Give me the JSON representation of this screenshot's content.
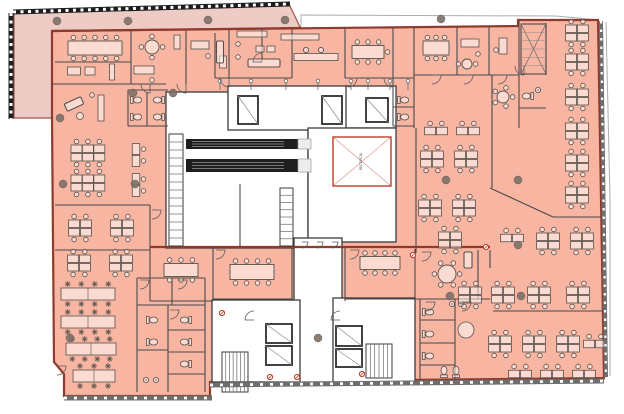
{
  "meta": {
    "document_type": "architectural office floor plan"
  },
  "colors": {
    "terrace": "#eecbc5",
    "office": "#f7b5a2",
    "office_border": "#8f3b2d",
    "wall": "#4a4a4a",
    "core_wall": "#3c3c3c",
    "white": "#ffffff",
    "furniture": "#57524c",
    "furniture_fill": "rgba(255,255,255,0.5)",
    "column": "#7d7168",
    "accent_red": "#c23b2a",
    "escalator": "#1e1e1e",
    "facade_dark": "#1d1d1d",
    "facade_gray": "#6e6e6e",
    "outline_gray": "#adadad"
  },
  "void_room": {
    "x": 333,
    "y": 137,
    "w": 58,
    "h": 49,
    "label": "RECEPCJA"
  },
  "plan": {
    "terrace_points": "14,12 289,4 301,29 52,31 52,118 14,118",
    "office_points": "52,31 518,26 518,20 598,20 604,378 210,382 210,396 64,396 64,374 54,362 52,118",
    "roof_outline": "301,29 301,15 556,16 598,20",
    "right_offset": "606,22 610,200 610,376",
    "cores": [
      [
        166,
        92,
        142,
        156
      ],
      [
        228,
        86,
        120,
        44
      ],
      [
        346,
        86,
        50,
        42
      ],
      [
        308,
        128,
        88,
        114
      ],
      [
        294,
        238,
        48,
        144
      ],
      [
        212,
        300,
        88,
        82
      ],
      [
        333,
        298,
        82,
        84
      ]
    ],
    "walls": [
      [
        131,
        31,
        131,
        84
      ],
      [
        186,
        30,
        186,
        84
      ],
      [
        215,
        33,
        215,
        78
      ],
      [
        229,
        30,
        229,
        78
      ],
      [
        262,
        29,
        262,
        62
      ],
      [
        292,
        29,
        292,
        78
      ],
      [
        345,
        28,
        345,
        78
      ],
      [
        393,
        28,
        393,
        88
      ],
      [
        414,
        27,
        414,
        128
      ],
      [
        457,
        27,
        457,
        75
      ],
      [
        489,
        27,
        489,
        75
      ],
      [
        519,
        20,
        519,
        75
      ],
      [
        546,
        23,
        546,
        75
      ],
      [
        519,
        75,
        519,
        128
      ],
      [
        519,
        108,
        546,
        108
      ],
      [
        55,
        62,
        131,
        62
      ],
      [
        52,
        84,
        166,
        84
      ],
      [
        215,
        78,
        292,
        78
      ],
      [
        345,
        78,
        414,
        78
      ],
      [
        414,
        75,
        519,
        75
      ],
      [
        128,
        90,
        168,
        90
      ],
      [
        128,
        90,
        128,
        126
      ],
      [
        128,
        126,
        168,
        126
      ],
      [
        147,
        92,
        147,
        126
      ],
      [
        393,
        88,
        393,
        126
      ],
      [
        393,
        126,
        414,
        126
      ],
      [
        393,
        107,
        414,
        107
      ],
      [
        55,
        205,
        150,
        205
      ],
      [
        150,
        205,
        150,
        250
      ],
      [
        55,
        250,
        150,
        250
      ],
      [
        137,
        278,
        205,
        278
      ],
      [
        172,
        278,
        172,
        305
      ],
      [
        137,
        305,
        205,
        305
      ],
      [
        137,
        278,
        137,
        392
      ],
      [
        205,
        278,
        205,
        392
      ],
      [
        168,
        305,
        168,
        392
      ],
      [
        168,
        330,
        205,
        330
      ],
      [
        168,
        352,
        205,
        352
      ],
      [
        137,
        350,
        168,
        350
      ],
      [
        168,
        374,
        205,
        374
      ],
      [
        150,
        249,
        150,
        301
      ],
      [
        213,
        246,
        213,
        301
      ],
      [
        292,
        246,
        292,
        301
      ],
      [
        345,
        246,
        345,
        301
      ],
      [
        415,
        249,
        415,
        301
      ],
      [
        150,
        301,
        213,
        301
      ],
      [
        213,
        299,
        292,
        299
      ],
      [
        345,
        299,
        420,
        299
      ],
      [
        478,
        250,
        478,
        299
      ],
      [
        420,
        299,
        420,
        380
      ],
      [
        420,
        299,
        490,
        299
      ],
      [
        455,
        299,
        455,
        380
      ],
      [
        490,
        250,
        490,
        268
      ],
      [
        420,
        320,
        455,
        320
      ],
      [
        420,
        343,
        455,
        343
      ],
      [
        420,
        365,
        455,
        365
      ],
      [
        492,
        75,
        492,
        188
      ],
      [
        490,
        188,
        553,
        217
      ],
      [
        553,
        217,
        604,
        217
      ],
      [
        493,
        311,
        604,
        311
      ],
      [
        416,
        128,
        416,
        253
      ],
      [
        240,
        184,
        240,
        248
      ]
    ],
    "heavy_walls": [
      [
        52,
        31,
        301,
        28
      ],
      [
        150,
        247,
        490,
        247
      ]
    ],
    "escalators": [
      {
        "x": 186,
        "y": 139,
        "w": 112,
        "h": 10
      },
      {
        "x": 186,
        "y": 159,
        "w": 112,
        "h": 13
      }
    ],
    "stairs": [
      {
        "x": 169,
        "y": 134,
        "w": 14,
        "h": 112,
        "n": 14,
        "dir": "v"
      },
      {
        "x": 280,
        "y": 188,
        "w": 13,
        "h": 58,
        "n": 8,
        "dir": "v"
      },
      {
        "x": 222,
        "y": 352,
        "w": 26,
        "h": 40,
        "n": 7,
        "dir": "h"
      },
      {
        "x": 366,
        "y": 344,
        "w": 26,
        "h": 34,
        "n": 6,
        "dir": "h"
      },
      {
        "x": 521,
        "y": 24,
        "w": 25,
        "h": 50,
        "n": 6,
        "dir": "x"
      }
    ],
    "elevators": [
      {
        "x": 238,
        "y": 96,
        "w": 20,
        "h": 28
      },
      {
        "x": 322,
        "y": 96,
        "w": 20,
        "h": 28
      },
      {
        "x": 366,
        "y": 98,
        "w": 22,
        "h": 24
      },
      {
        "x": 266,
        "y": 324,
        "w": 26,
        "h": 19
      },
      {
        "x": 266,
        "y": 346,
        "w": 26,
        "h": 19
      },
      {
        "x": 336,
        "y": 326,
        "w": 26,
        "h": 20
      },
      {
        "x": 336,
        "y": 349,
        "w": 26,
        "h": 18
      }
    ],
    "gates": [
      [
        302,
        242
      ],
      [
        317,
        242
      ],
      [
        332,
        242
      ]
    ],
    "doors": [
      [
        150,
        84,
        90
      ],
      [
        186,
        84,
        90
      ],
      [
        229,
        78,
        90
      ],
      [
        262,
        62,
        180
      ],
      [
        348,
        78,
        0
      ],
      [
        393,
        78,
        90
      ],
      [
        432,
        75,
        0
      ],
      [
        464,
        75,
        0
      ],
      [
        498,
        75,
        0
      ],
      [
        152,
        210,
        0
      ],
      [
        140,
        280,
        0
      ],
      [
        178,
        280,
        0
      ],
      [
        216,
        250,
        0
      ],
      [
        350,
        250,
        0
      ],
      [
        422,
        252,
        0
      ],
      [
        57,
        366,
        0
      ],
      [
        170,
        310,
        0
      ],
      [
        426,
        302,
        0
      ],
      [
        462,
        302,
        0
      ],
      [
        340,
        320,
        180
      ],
      [
        254,
        320,
        180
      ],
      [
        524,
        66,
        90
      ]
    ],
    "risers": {
      "y": 81,
      "xs": [
        220,
        251,
        286,
        318,
        351,
        368,
        390,
        408
      ]
    },
    "columns": [
      [
        57,
        21
      ],
      [
        128,
        21
      ],
      [
        208,
        20
      ],
      [
        285,
        20
      ],
      [
        441,
        19
      ],
      [
        133,
        93
      ],
      [
        173,
        93
      ],
      [
        60,
        118
      ],
      [
        63,
        184
      ],
      [
        135,
        184
      ],
      [
        446,
        180
      ],
      [
        518,
        180
      ],
      [
        518,
        245
      ],
      [
        70,
        338
      ],
      [
        318,
        338
      ],
      [
        450,
        296
      ],
      [
        521,
        296
      ]
    ],
    "red_markers": [
      [
        222,
        313
      ],
      [
        270,
        377
      ],
      [
        297,
        377
      ],
      [
        362,
        374
      ],
      [
        486,
        247
      ],
      [
        413,
        255
      ]
    ],
    "furniture": [
      {
        "t": "mtg",
        "x": 95,
        "y": 48,
        "w": 54,
        "h": 14,
        "n": 10
      },
      {
        "t": "rect",
        "x": 74,
        "y": 71,
        "w": 13,
        "h": 8
      },
      {
        "t": "rect",
        "x": 90,
        "y": 71,
        "w": 10,
        "h": 8
      },
      {
        "t": "rect",
        "x": 112,
        "y": 72,
        "w": 5,
        "h": 16
      },
      {
        "t": "round",
        "x": 152,
        "y": 47,
        "rad": 7,
        "n": 4
      },
      {
        "t": "rect",
        "x": 144,
        "y": 70,
        "w": 20,
        "h": 8
      },
      {
        "t": "chair",
        "x": 152,
        "y": 80
      },
      {
        "t": "rect",
        "x": 177,
        "y": 42,
        "w": 6,
        "h": 14
      },
      {
        "t": "rect",
        "x": 200,
        "y": 45,
        "w": 18,
        "h": 8
      },
      {
        "t": "chair",
        "x": 208,
        "y": 56
      },
      {
        "t": "rect",
        "x": 223,
        "y": 62,
        "w": 7,
        "h": 12
      },
      {
        "t": "sofa",
        "x": 220,
        "y": 52,
        "w": 7,
        "h": 22
      },
      {
        "t": "rect",
        "x": 252,
        "y": 34,
        "w": 30,
        "h": 6
      },
      {
        "t": "rect",
        "x": 260,
        "y": 49,
        "w": 8,
        "h": 6
      },
      {
        "t": "rect",
        "x": 271,
        "y": 49,
        "w": 8,
        "h": 6
      },
      {
        "t": "sofa",
        "x": 264,
        "y": 63,
        "w": 32,
        "h": 8
      },
      {
        "t": "chair",
        "x": 238,
        "y": 44
      },
      {
        "t": "chair",
        "x": 238,
        "y": 57
      },
      {
        "t": "rect",
        "x": 300,
        "y": 37,
        "w": 38,
        "h": 6
      },
      {
        "t": "rect",
        "x": 316,
        "y": 57,
        "w": 44,
        "h": 7
      },
      {
        "t": "stool",
        "x": 306,
        "y": 50
      },
      {
        "t": "stool",
        "x": 321,
        "y": 50
      },
      {
        "t": "mtg",
        "x": 368,
        "y": 52,
        "w": 32,
        "h": 13,
        "n": 7
      },
      {
        "t": "mtg",
        "x": 436,
        "y": 48,
        "w": 26,
        "h": 14,
        "n": 6
      },
      {
        "t": "rect",
        "x": 470,
        "y": 43,
        "w": 18,
        "h": 8
      },
      {
        "t": "chair",
        "x": 478,
        "y": 54
      },
      {
        "t": "round",
        "x": 467,
        "y": 64,
        "rad": 5,
        "n": 2
      },
      {
        "t": "rect",
        "x": 503,
        "y": 46,
        "w": 8,
        "h": 16
      },
      {
        "t": "chair",
        "x": 496,
        "y": 50
      },
      {
        "t": "round",
        "x": 503,
        "y": 97,
        "rad": 6,
        "n": 5
      },
      {
        "t": "wc",
        "x": 528,
        "y": 96,
        "r": 90
      },
      {
        "t": "sink",
        "x": 538,
        "y": 90
      },
      {
        "t": "wc",
        "x": 136,
        "y": 100,
        "r": -90
      },
      {
        "t": "wc",
        "x": 136,
        "y": 117,
        "r": -90
      },
      {
        "t": "wc",
        "x": 159,
        "y": 100,
        "r": 90
      },
      {
        "t": "wc",
        "x": 159,
        "y": 117,
        "r": 90
      },
      {
        "t": "wc",
        "x": 403,
        "y": 100,
        "r": -90
      },
      {
        "t": "wc",
        "x": 403,
        "y": 117,
        "r": -90
      },
      {
        "t": "sofa",
        "x": 74,
        "y": 104,
        "w": 18,
        "h": 8,
        "r": -25
      },
      {
        "t": "circ",
        "x": 80,
        "y": 116,
        "rad": 3.5
      },
      {
        "t": "rect",
        "x": 101,
        "y": 108,
        "w": 6,
        "h": 26
      },
      {
        "t": "chair",
        "x": 92,
        "y": 95
      },
      {
        "t": "c6",
        "x": 88,
        "y": 153
      },
      {
        "t": "c6",
        "x": 88,
        "y": 183
      },
      {
        "t": "c2",
        "x": 136,
        "y": 155,
        "r": 90
      },
      {
        "t": "c2",
        "x": 136,
        "y": 185,
        "r": 90
      },
      {
        "t": "c4",
        "x": 80,
        "y": 228
      },
      {
        "t": "c4",
        "x": 122,
        "y": 228
      },
      {
        "t": "c4",
        "x": 79,
        "y": 263
      },
      {
        "t": "c4",
        "x": 121,
        "y": 263
      },
      {
        "t": "bench",
        "x": 88,
        "y": 294,
        "w": 54,
        "n": 4
      },
      {
        "t": "bench",
        "x": 88,
        "y": 322,
        "w": 54,
        "n": 4
      },
      {
        "t": "bench",
        "x": 91,
        "y": 349,
        "w": 50,
        "n": 4
      },
      {
        "t": "bench",
        "x": 94,
        "y": 376,
        "w": 42,
        "n": 3
      },
      {
        "t": "wc",
        "x": 152,
        "y": 320,
        "r": -90
      },
      {
        "t": "wc",
        "x": 152,
        "y": 342,
        "r": -90
      },
      {
        "t": "wc",
        "x": 186,
        "y": 320,
        "r": 90
      },
      {
        "t": "wc",
        "x": 186,
        "y": 342,
        "r": 90
      },
      {
        "t": "wc",
        "x": 186,
        "y": 364,
        "r": 90
      },
      {
        "t": "sink",
        "x": 146,
        "y": 380
      },
      {
        "t": "sink",
        "x": 156,
        "y": 380
      },
      {
        "t": "mtg",
        "x": 181,
        "y": 270,
        "w": 34,
        "h": 13,
        "n": 6
      },
      {
        "t": "mtg",
        "x": 252,
        "y": 272,
        "w": 44,
        "h": 15,
        "n": 8
      },
      {
        "t": "mtg",
        "x": 380,
        "y": 263,
        "w": 40,
        "h": 13,
        "n": 8
      },
      {
        "t": "round",
        "x": 447,
        "y": 274,
        "rad": 9,
        "n": 6
      },
      {
        "t": "sofa",
        "x": 468,
        "y": 260,
        "w": 8,
        "h": 16
      },
      {
        "t": "wc",
        "x": 428,
        "y": 312,
        "r": -90
      },
      {
        "t": "wc",
        "x": 428,
        "y": 334,
        "r": -90
      },
      {
        "t": "wc",
        "x": 428,
        "y": 356,
        "r": -90
      },
      {
        "t": "circ",
        "x": 466,
        "y": 330,
        "rad": 8
      },
      {
        "t": "sink",
        "x": 452,
        "y": 304
      },
      {
        "t": "sink",
        "x": 461,
        "y": 304
      },
      {
        "t": "wc",
        "x": 444,
        "y": 372,
        "r": 180
      },
      {
        "t": "wc",
        "x": 456,
        "y": 372,
        "r": 180
      },
      {
        "t": "c2",
        "x": 436,
        "y": 131
      },
      {
        "t": "c2",
        "x": 468,
        "y": 131
      },
      {
        "t": "c4",
        "x": 432,
        "y": 159
      },
      {
        "t": "c4",
        "x": 466,
        "y": 159
      },
      {
        "t": "c4",
        "x": 430,
        "y": 208
      },
      {
        "t": "c4",
        "x": 464,
        "y": 208
      },
      {
        "t": "c4",
        "x": 450,
        "y": 240
      },
      {
        "t": "c2",
        "x": 512,
        "y": 238
      },
      {
        "t": "c4",
        "x": 577,
        "y": 33
      },
      {
        "t": "c4",
        "x": 577,
        "y": 62
      },
      {
        "t": "c4",
        "x": 577,
        "y": 97
      },
      {
        "t": "c4",
        "x": 577,
        "y": 131
      },
      {
        "t": "c4",
        "x": 577,
        "y": 163
      },
      {
        "t": "c4",
        "x": 577,
        "y": 195
      },
      {
        "t": "c4",
        "x": 548,
        "y": 241
      },
      {
        "t": "c4",
        "x": 582,
        "y": 241
      },
      {
        "t": "c4",
        "x": 470,
        "y": 295
      },
      {
        "t": "c4",
        "x": 503,
        "y": 295
      },
      {
        "t": "c4",
        "x": 539,
        "y": 295
      },
      {
        "t": "c4",
        "x": 578,
        "y": 295
      },
      {
        "t": "c4",
        "x": 500,
        "y": 344
      },
      {
        "t": "c4",
        "x": 534,
        "y": 344
      },
      {
        "t": "c4",
        "x": 568,
        "y": 344
      },
      {
        "t": "c2",
        "x": 595,
        "y": 344
      },
      {
        "t": "c2",
        "x": 520,
        "y": 374
      },
      {
        "t": "c2",
        "x": 552,
        "y": 374
      },
      {
        "t": "c2",
        "x": 584,
        "y": 374
      }
    ]
  }
}
